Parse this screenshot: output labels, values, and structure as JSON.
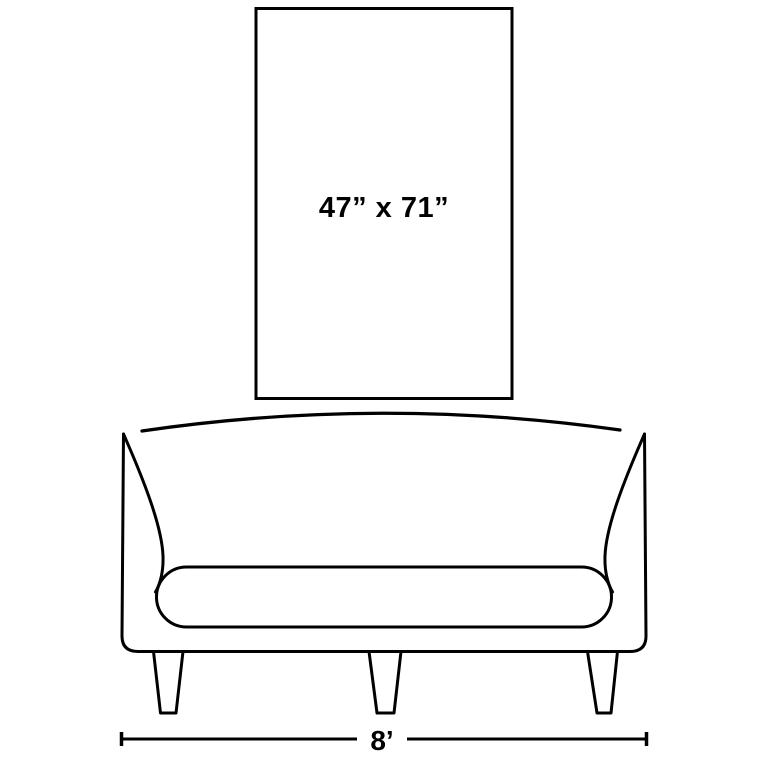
{
  "colors": {
    "ink": "#000000",
    "background": "#ffffff"
  },
  "artwork": {
    "dimensions_label": "47” x 71”"
  },
  "sofa": {
    "width_label": "8’"
  }
}
